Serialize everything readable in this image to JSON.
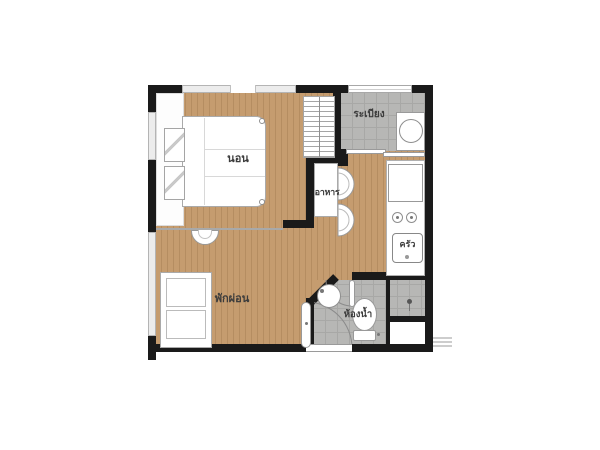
{
  "floorplan": {
    "rooms": {
      "bedroom": {
        "label": "นอน"
      },
      "balcony": {
        "label": "ระเบียง"
      },
      "dining": {
        "label": "อาหาร"
      },
      "kitchen": {
        "label": "ครัว"
      },
      "living": {
        "label": "พักผ่อน"
      },
      "bathroom": {
        "label": "ห้องน้ำ"
      }
    },
    "fixtures": [
      "bed",
      "pillows",
      "wardrobe",
      "window",
      "washing-machine",
      "sliding-door",
      "dining-table",
      "chairs",
      "refrigerator",
      "stove-burners",
      "kitchen-sink",
      "sofa",
      "console-table",
      "entrance-door",
      "bathroom-door",
      "bathroom-sink",
      "toilet",
      "shower-head",
      "ac-ledge"
    ],
    "colors": {
      "wall": "#1a1a1a",
      "wood_floor": "#c59c6f",
      "wood_line": "#b58d61",
      "tile_floor": "#b7b7b5",
      "tile_line": "#a8a8a6",
      "fixture_fill": "#ffffff",
      "fixture_border": "#9a9a9a",
      "label_text": "#3c3c3c",
      "background": "#ffffff"
    }
  }
}
